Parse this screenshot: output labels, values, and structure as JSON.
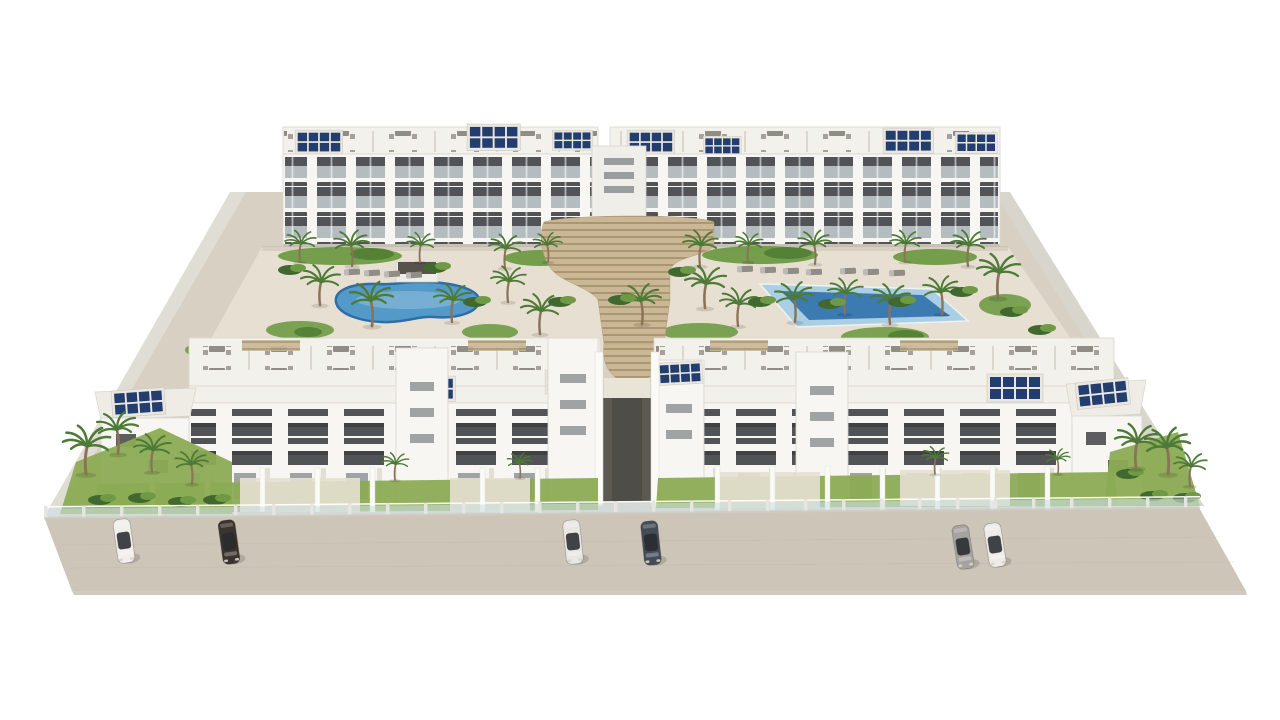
{
  "scene": {
    "type": "3d-architectural-render",
    "view": "aerial-front",
    "subject": "Aerial 3D rendering of a white modern apartment complex: two rear blocks and two front blocks with roof terraces and solar panels, central timber stairway, two swimming pools, palm gardens, glass perimeter fence and six cars parked on the street",
    "background": "#ffffff"
  },
  "palette": {
    "building-white": "#f7f6f2",
    "building-shade": "#f3f1ec",
    "window-dark": "#3f4245",
    "window-rail": "#cdd6d9",
    "solar-blue": "#223d6e",
    "stair-wood": "#c9b795",
    "stair-shadow": "#a28e69",
    "grass": "#8cab54",
    "garden-green": "#6f9a45",
    "garden-dark": "#4e7c33",
    "bush-green": "#41682e",
    "palm-green": "#4d7a36",
    "palm-trunk": "#8a7356",
    "furniture-gray": "#8f8d85",
    "glass-fence": "#cfdfe4",
    "platform": "#d8d0c2",
    "courtyard": "#e7e0d2",
    "street": "#cdc5b8",
    "street-edge": "#a89f90",
    "wall-light": "#e0ddd5",
    "wall-shade": "#d8d5cc",
    "pool-rim": "#2e6da6",
    "pool-water": "#549ac9",
    "pool-shelf": "#aacfe4",
    "pool-deep": "#3c7ab2",
    "gate-dark": "#5c5953"
  },
  "site": {
    "building_rows": 2,
    "floors_per_block": 3,
    "swimming_pools": 2,
    "pool_shapes": [
      "kidney",
      "rectangular"
    ],
    "solar_arrays": 14,
    "palm_trees_approx": 38,
    "parked_cars": 6,
    "cars": [
      {
        "color": "#f1efeb",
        "tone": "white"
      },
      {
        "color": "#3b332e",
        "tone": "dark-brown"
      },
      {
        "color": "#e9e7e3",
        "tone": "silver-white"
      },
      {
        "color": "#434c57",
        "tone": "dark-gray-blue"
      },
      {
        "color": "#a5a3a0",
        "tone": "gray"
      },
      {
        "color": "#eeece8",
        "tone": "white-black-roof"
      }
    ],
    "features": [
      "roof terraces with outdoor furniture",
      "rooftop solar panels",
      "central timber amphitheater stairs",
      "sun loungers",
      "glass perimeter fence",
      "front yards with lawns"
    ]
  }
}
